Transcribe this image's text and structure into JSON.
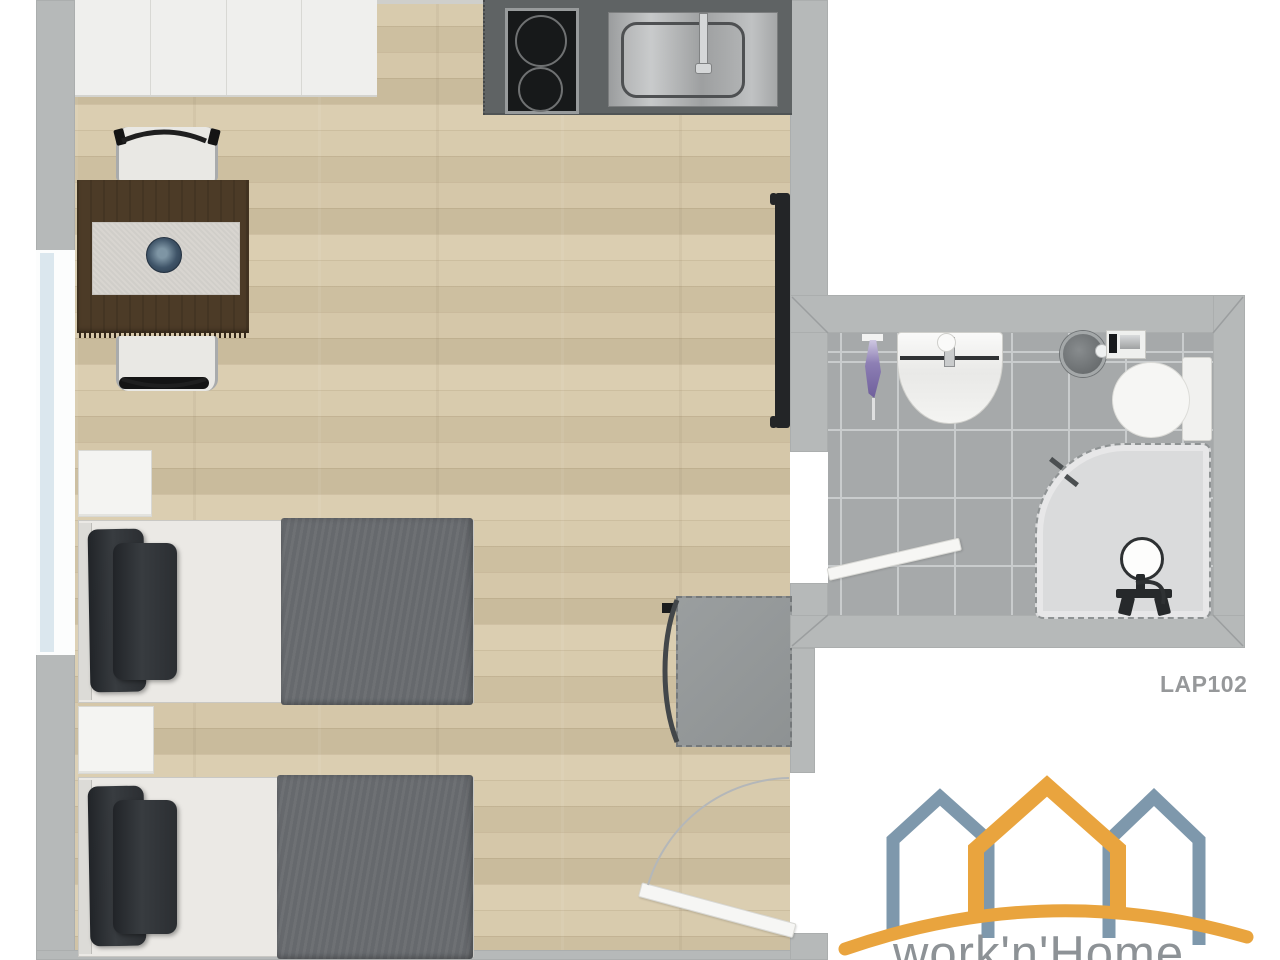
{
  "floorplan": {
    "unit_label": "LAP102",
    "logo": {
      "text": "work'n'Home",
      "side_house_color": "#7E98AC",
      "center_house_color": "#E9A43E",
      "text_color": "#8D9296"
    },
    "palette": {
      "wall": "#B6B9B9",
      "wood_floor": "#D2C4A5",
      "bathroom_tile": "#A6A9AA",
      "kitchen_counter": "#5F6364",
      "bed_duvet": "#66696D",
      "table_wood": "#4C3B27",
      "window_glass": "#DBE7EE"
    },
    "main_room": {
      "furniture": [
        "wardrobe-cabinets",
        "kitchen-counter",
        "induction-hob",
        "kitchen-sink",
        "dining-table",
        "table-runner",
        "decor-bowl",
        "dining-chair-top",
        "dining-chair-bottom",
        "wall-tv",
        "armchair",
        "nightstand-1",
        "bed-1",
        "nightstand-2",
        "bed-2",
        "entry-door",
        "window"
      ]
    },
    "bathroom": {
      "fixtures": [
        "washbasin",
        "toilet",
        "toilet-tank",
        "round-bin",
        "wall-accessory",
        "toilet-brush",
        "corner-shower",
        "shower-stool",
        "bathroom-door"
      ]
    }
  }
}
